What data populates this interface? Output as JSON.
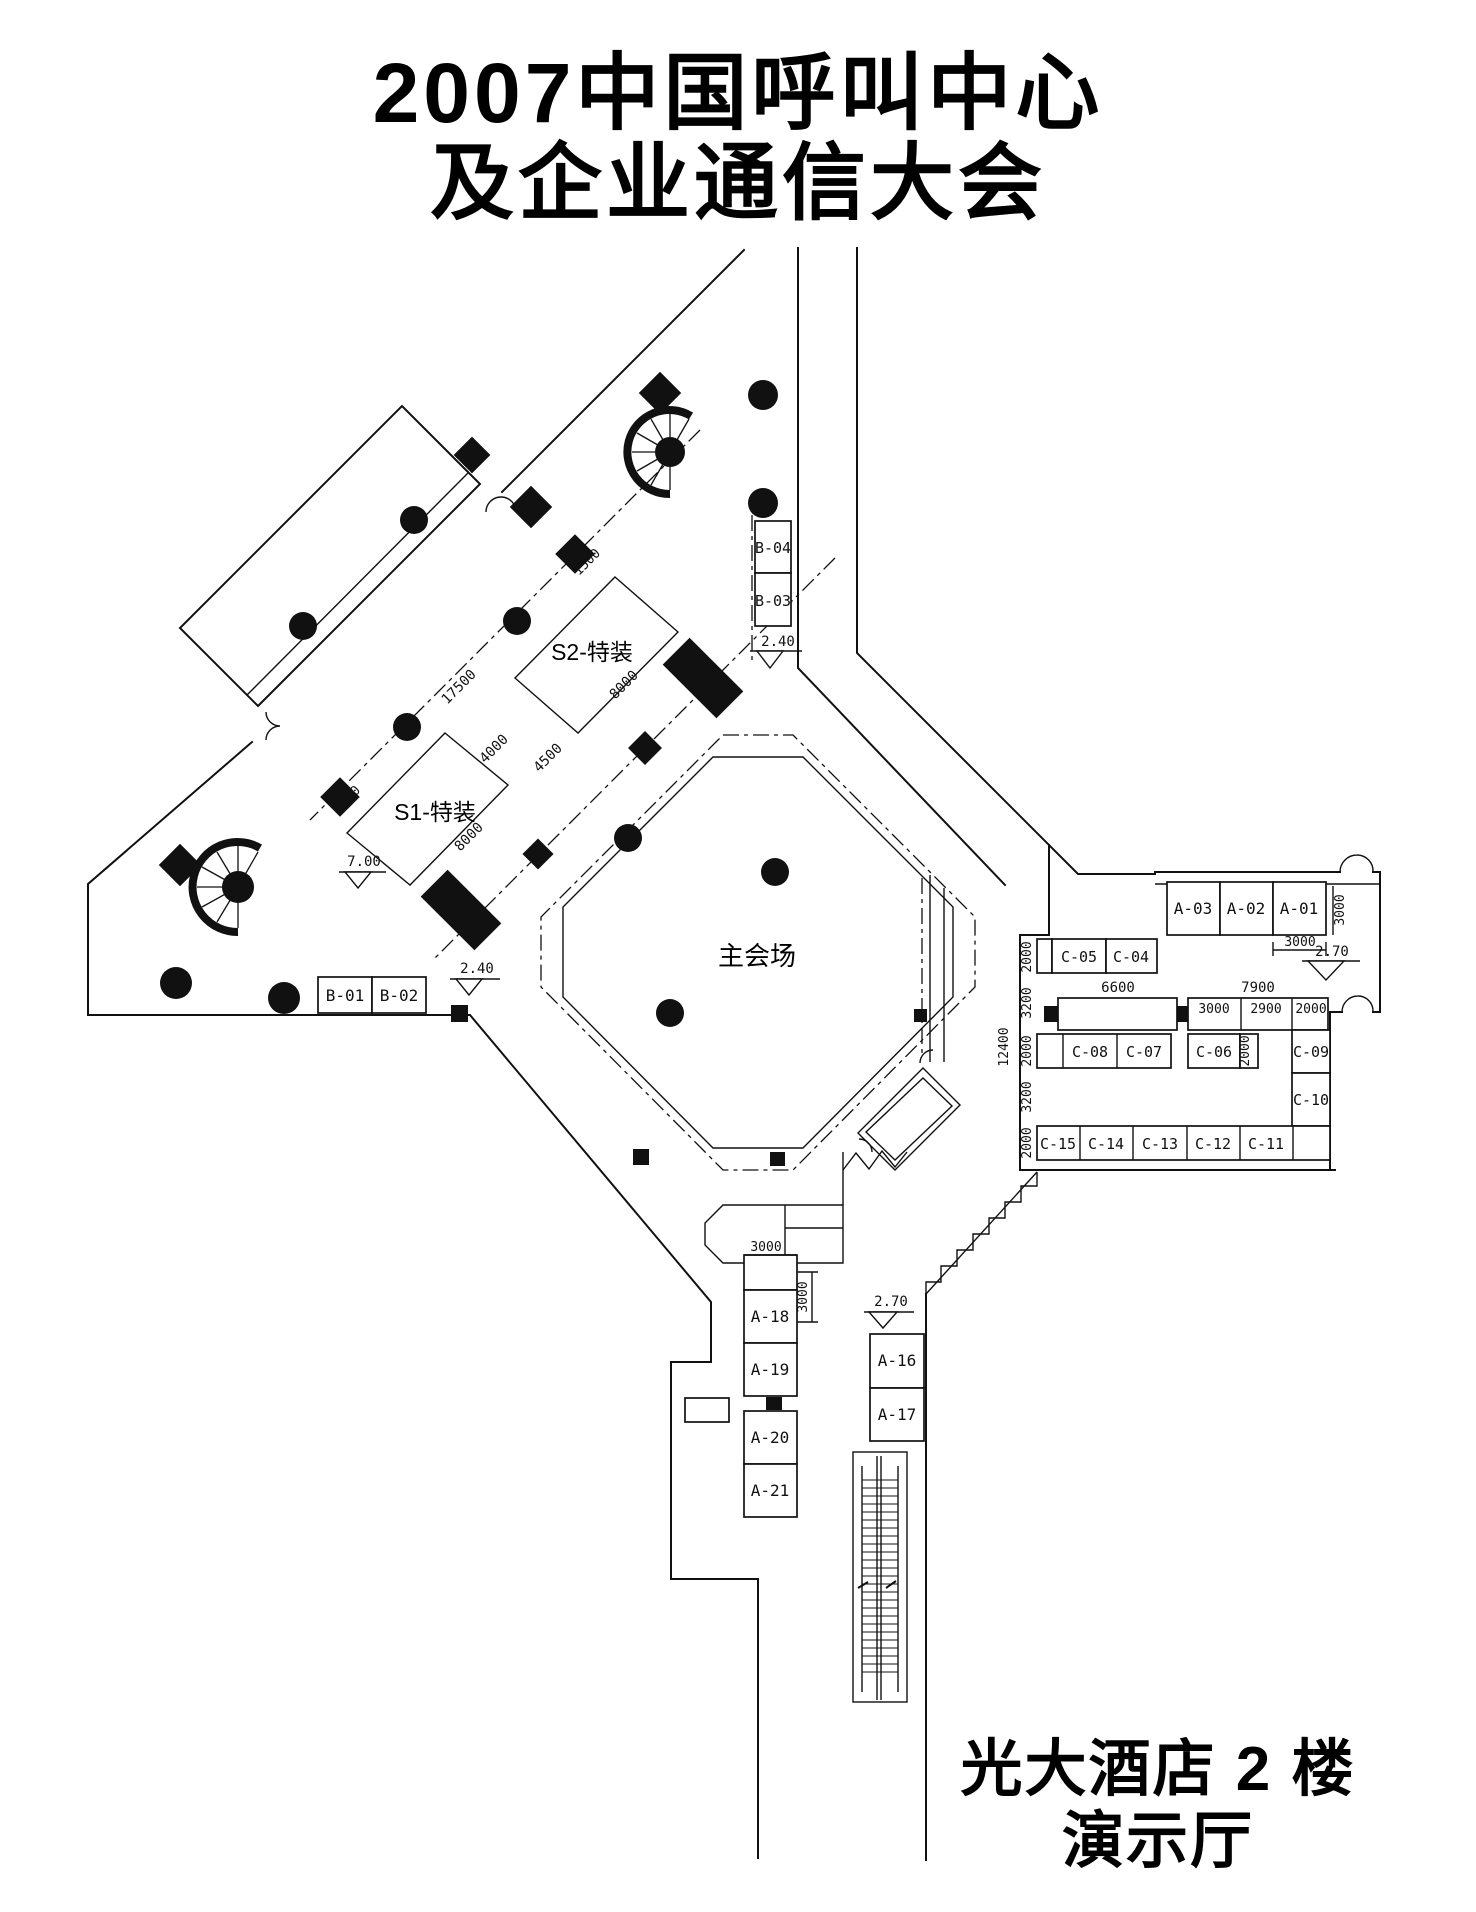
{
  "title": {
    "line1": "2007中国呼叫中心",
    "line2": "及企业通信大会"
  },
  "footer": {
    "line1": "光大酒店 2 楼",
    "line2": "演示厅"
  },
  "halls": {
    "main": "主会场",
    "s1": "S1-特装",
    "s2": "S2-特装"
  },
  "booths": {
    "b01": "B-01",
    "b02": "B-02",
    "b03": "B-03",
    "b04": "B-04",
    "a01": "A-01",
    "a02": "A-02",
    "a03": "A-03",
    "a16": "A-16",
    "a17": "A-17",
    "a18": "A-18",
    "a19": "A-19",
    "a20": "A-20",
    "a21": "A-21",
    "c04": "C-04",
    "c05": "C-05",
    "c06": "C-06",
    "c07": "C-07",
    "c08": "C-08",
    "c09": "C-09",
    "c10": "C-10",
    "c11": "C-11",
    "c12": "C-12",
    "c13": "C-13",
    "c14": "C-14",
    "c15": "C-15"
  },
  "dimensions": {
    "d17500": "17500",
    "d8000_s2": "8000",
    "d8000_s1": "8000",
    "d4000": "4000",
    "d4500": "4500",
    "d1500_top": "1500",
    "d1500_mid": "1500",
    "d3000_a01_h": "3000",
    "d3000_a01_v": "3000",
    "d7900": "7900",
    "d6600": "6600",
    "d3000_sub": "3000",
    "d2900_sub": "2900",
    "d2000_sub": "2000",
    "d12400": "12400",
    "d2000_r1": "2000",
    "d3200_r1": "3200",
    "d2000_r2": "2000",
    "d3200_r2": "3200",
    "d2000_r3": "2000",
    "d2000_c06": "2000",
    "d3000_a18_h": "3000",
    "d3000_a18_v": "3000"
  },
  "elevations": {
    "e240_top": "2.40",
    "e240_left": "2.40",
    "e700": "7.00",
    "e270_right": "2.70",
    "e270_mid": "2.70"
  }
}
